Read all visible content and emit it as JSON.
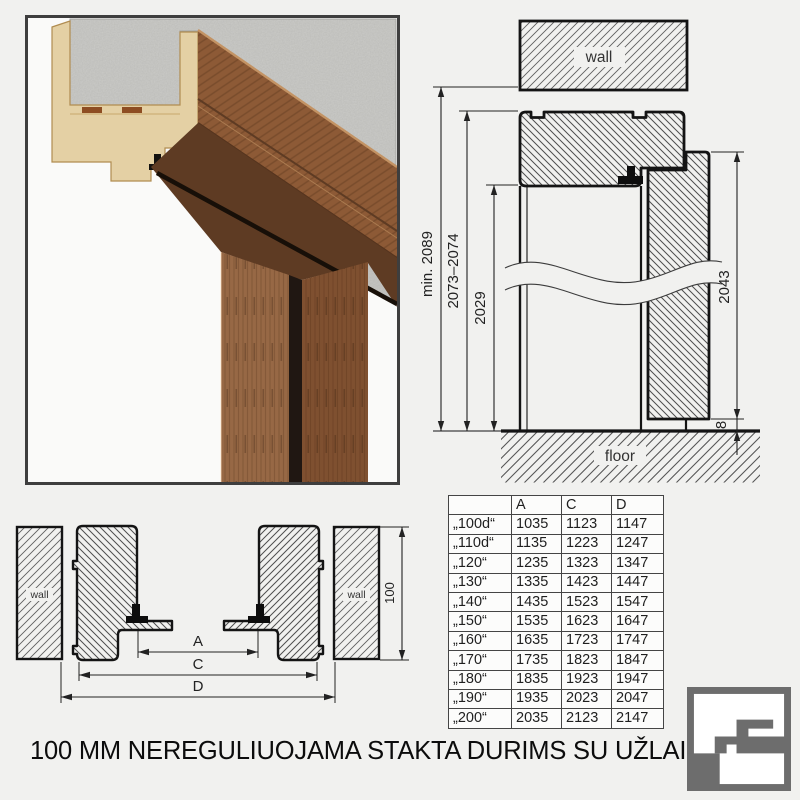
{
  "title": "100 MM NEREGULIUOJAMA STAKTA DURIMS SU UŽLAIDA",
  "vertical_section": {
    "wall_label": "wall",
    "floor_label": "floor",
    "min_opening_height": "min. 2089",
    "frame_outer_height": "2073–2074",
    "clear_opening_height": "2029",
    "door_leaf_height": "2043",
    "floor_gap": "8"
  },
  "horizontal_section": {
    "wall_left_label": "wall",
    "wall_right_label": "wall",
    "frame_depth": "100",
    "dim_a": "A",
    "dim_c": "C",
    "dim_d": "D"
  },
  "table": {
    "headers": [
      "",
      "A",
      "C",
      "D"
    ],
    "rows": [
      [
        "„100d“",
        "1035",
        "1123",
        "1147"
      ],
      [
        "„110d“",
        "1135",
        "1223",
        "1247"
      ],
      [
        "„120“",
        "1235",
        "1323",
        "1347"
      ],
      [
        "„130“",
        "1335",
        "1423",
        "1447"
      ],
      [
        "„140“",
        "1435",
        "1523",
        "1547"
      ],
      [
        "„150“",
        "1535",
        "1623",
        "1647"
      ],
      [
        "„160“",
        "1635",
        "1723",
        "1747"
      ],
      [
        "„170“",
        "1735",
        "1823",
        "1847"
      ],
      [
        "„180“",
        "1835",
        "1923",
        "1947"
      ],
      [
        "„190“",
        "1935",
        "2023",
        "2047"
      ],
      [
        "„200“",
        "2035",
        "2123",
        "2147"
      ]
    ]
  },
  "colors": {
    "logo_gray": "#6d6d6d",
    "line": "#141414",
    "wood": "#8d5a36",
    "mdf": "#e4d0a4",
    "concrete": "#cbcbc8"
  }
}
